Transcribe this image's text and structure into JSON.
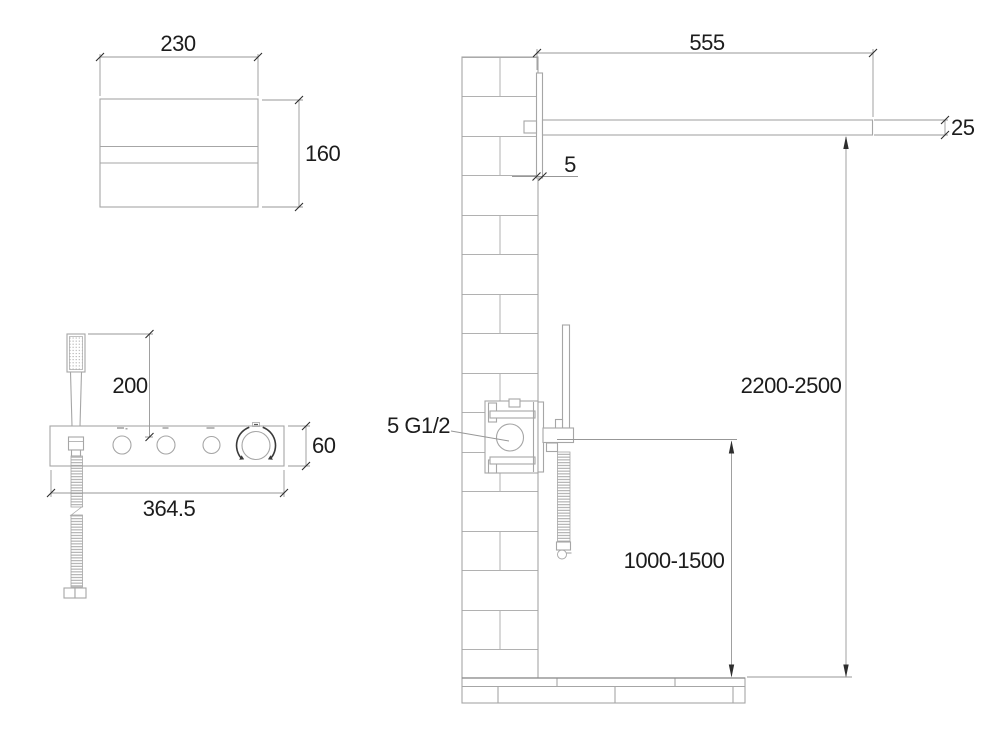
{
  "views": {
    "spout_front_view": {
      "dim_width": "230",
      "dim_height": "160"
    },
    "panel_front_view": {
      "dim_handshower_height": "200",
      "dim_width": "364.5",
      "dim_height": "60"
    },
    "installation_side_view": {
      "dim_spout_length": "555",
      "dim_spout_thickness": "25",
      "dim_plate_thickness": "5",
      "label_connection": "5 G1/2",
      "dim_height_overall": "2200-2500",
      "dim_height_mixer": "1000-1500"
    }
  },
  "colors": {
    "geometry_line": "#a6a6a6",
    "dimension_line": "#979797",
    "tick_and_arrow": "#2e2e2e",
    "text": "#1c1c1c",
    "background": "#ffffff"
  }
}
